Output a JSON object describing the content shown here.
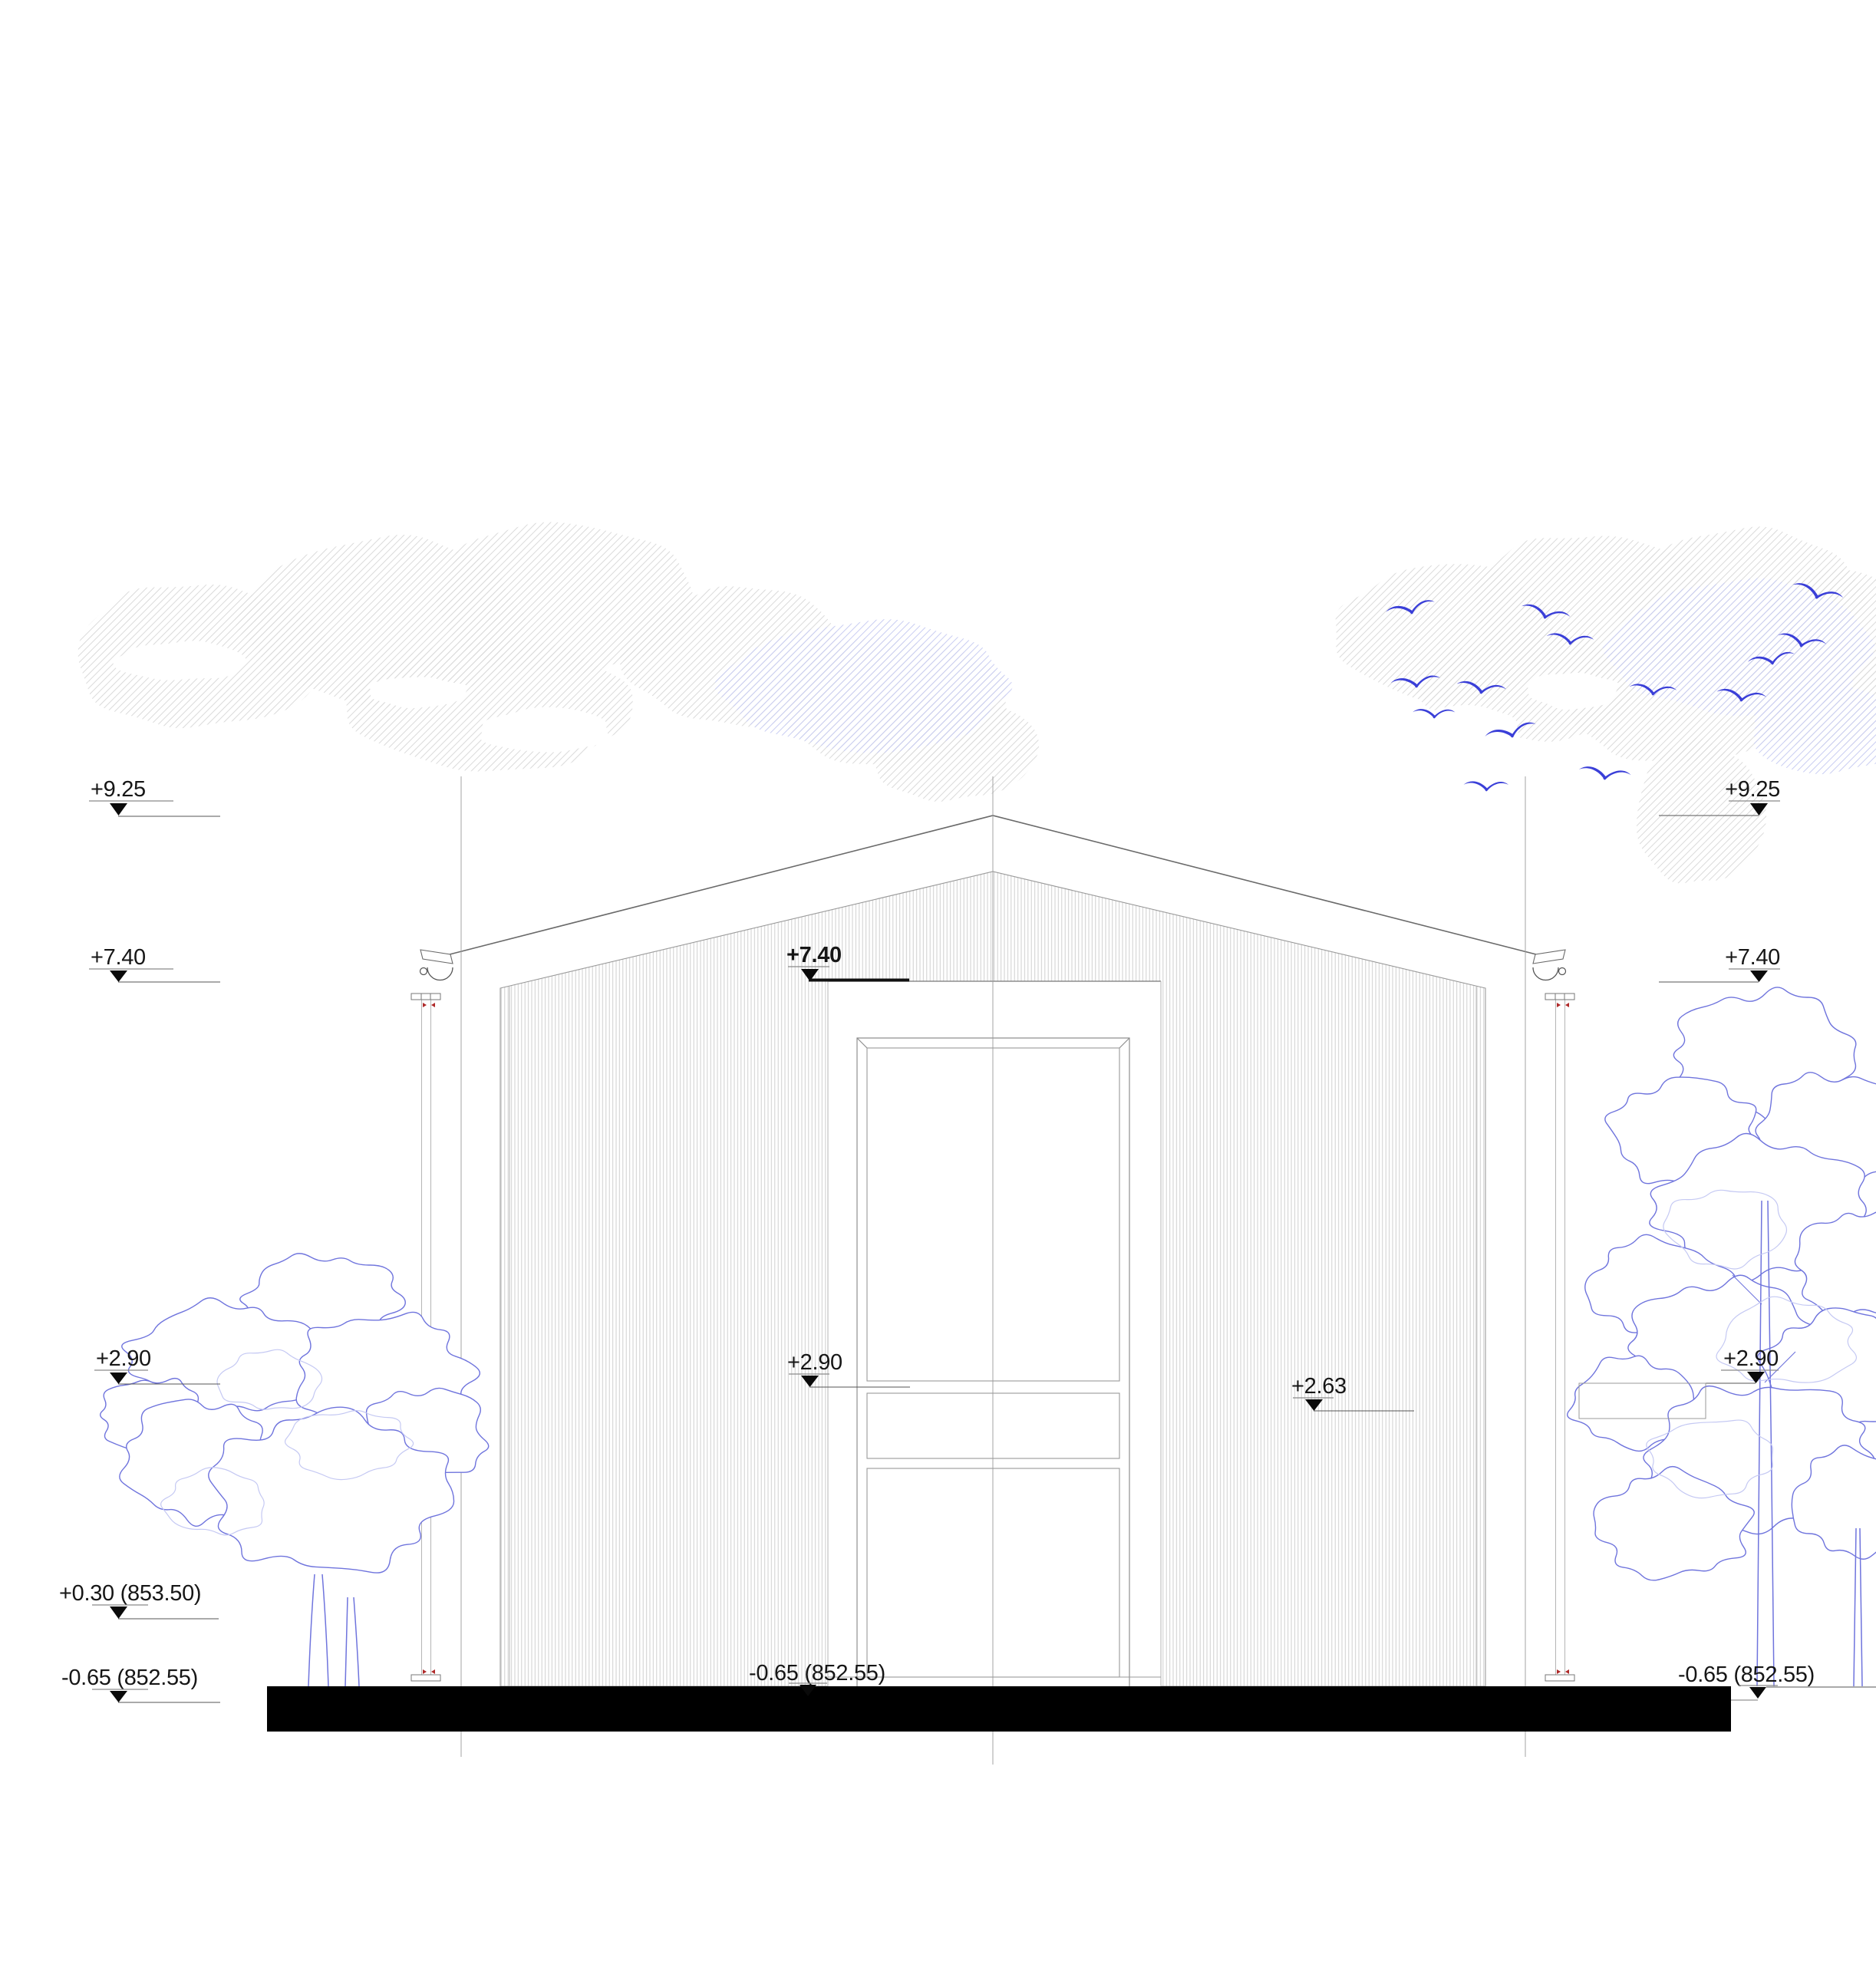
{
  "drawing": {
    "colors": {
      "line": "#6a6a6a",
      "wall_hatch": "#cfcfcf",
      "cloud_hatch_gray": "#dadada",
      "cloud_hatch_blue": "#c9cdf2",
      "tree_line": "#6f74dd",
      "tree_inner_line": "#c5c9f3",
      "bird_blue": "#3a3fd8",
      "ground_black": "#000000",
      "marker_red": "#b02a2a"
    }
  },
  "levels": {
    "left": [
      {
        "label": "+9.25"
      },
      {
        "label": "+7.40"
      },
      {
        "label": "+2.90"
      },
      {
        "label": "+0.30 (853.50)"
      },
      {
        "label": "-0.65 (852.55)"
      }
    ],
    "center": [
      {
        "label": "+7.40"
      },
      {
        "label": "+2.90"
      },
      {
        "label": "+2.63"
      },
      {
        "label": "-0.65 (852.55)"
      }
    ],
    "right": [
      {
        "label": "+9.25"
      },
      {
        "label": "+7.40"
      },
      {
        "label": "+2.90"
      },
      {
        "label": "-0.65 (852.55)"
      }
    ]
  }
}
